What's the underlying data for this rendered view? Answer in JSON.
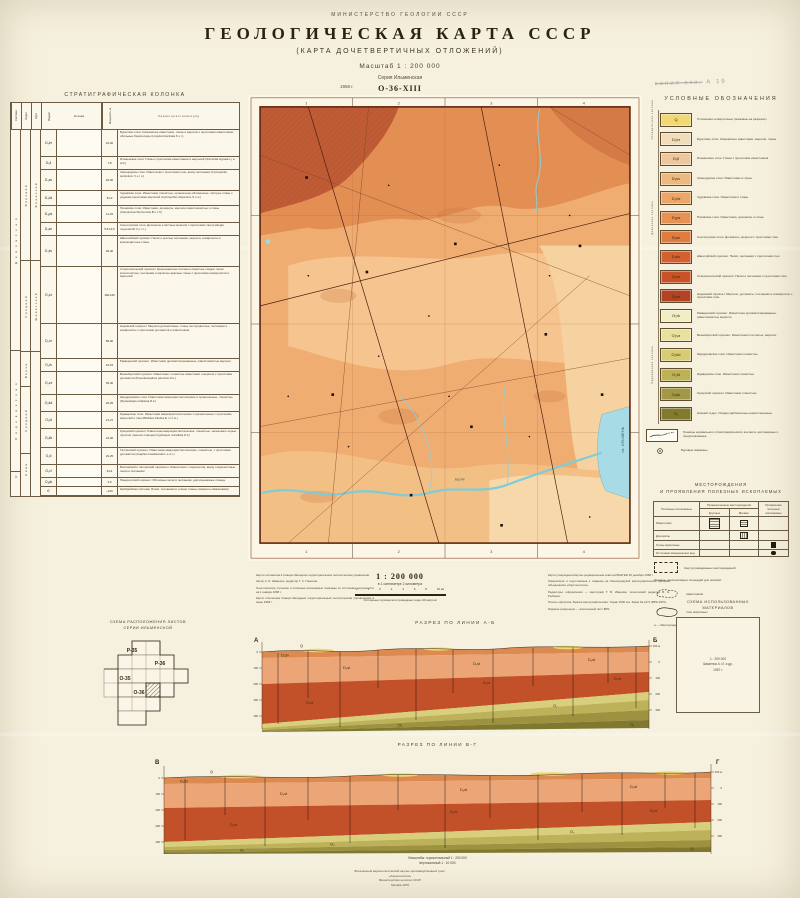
{
  "header": {
    "ministry": "МИНИСТЕРСТВО  ГЕОЛОГИИ  СССР",
    "title": "ГЕОЛОГИЧЕСКАЯ  КАРТА  СССР",
    "subtitle": "(КАРТА  ДОЧЕТВЕРТИЧНЫХ  ОТЛОЖЕНИЙ)",
    "scale": "Масштаб 1 : 200 000",
    "series": "Серия Ильменская",
    "sheet": "О-36-XIII",
    "year": "1958 г.",
    "stamp_strike": "копия экз.",
    "stamp": "А 19"
  },
  "strat": {
    "title": "СТРАТИГРАФИЧЕСКАЯ  КОЛОНКА",
    "head": {
      "system": "Система",
      "otdel": "Отдел",
      "yarus": "Ярус",
      "index": "Индекс",
      "column": "Колонка",
      "thickness": "Мощность, м",
      "desc": "Х а р а к т е р и с т и к а   п о р о д"
    },
    "systems": {
      "devon": "Д е в о н с к а я",
      "ordovik": "О р д о в и к с к а я",
      "cambr": "Є"
    },
    "otdels": {
      "o1": "Верхний",
      "o2": "Средний",
      "o3": "Верхн.",
      "o4": "Средний",
      "o5": "Нижн."
    },
    "yaruses": {
      "y1": "Франский",
      "y2": "Живетский"
    },
    "rows": [
      {
        "index": "D₃br",
        "thick": "10-30",
        "pattern": "limestone",
        "h": "26px",
        "desc": "Бурегские слои. Комковатые известняки, глины и мергели с прослоями известняков; обильные брахиоподы (Lingula bicarinata K u t.)"
      },
      {
        "index": "D₃il",
        "thick": "7-8",
        "pattern": "clay",
        "h": "12px",
        "desc": "Ильменские слои. Глины с прослоями известняков и мергелей (Svinordia signata L j a sch.)"
      },
      {
        "index": "D₃sv",
        "thick": "20-30",
        "pattern": "limestone",
        "h": "20px",
        "desc": "Свинордские слои. Известняки с прослоями глин, внизу песчаники (Cyrtospirifer tenticulum V e r n.)"
      },
      {
        "index": "D₃čd",
        "thick": "8-10",
        "pattern": "limestone",
        "h": "14px",
        "desc": "Чудовские слои. Известняки глинистые, органогенно-обломочные, пёстрые глины с редкими прослоями мергелей (Cyrtospirifer disjunctus S o w.)"
      },
      {
        "index": "D₃ps",
        "thick": "11-23",
        "pattern": "dolomite",
        "h": "16px",
        "desc": "Псковские слои. Известняки, доломиты, мергели известковистые и глины (Camarotoechia livonica B u c h)"
      },
      {
        "index": "D₃sn",
        "thick": "5,5-10,5",
        "pattern": "marl",
        "h": "12px",
        "desc": "Снетогорские слои. Доломиты и пёстрые мергели с прослоями глин (Ladogia meyendorfii V e r n.)"
      },
      {
        "index": "D₃šv",
        "thick": "30-40",
        "pattern": "sand",
        "h": "30px",
        "desc": "Швентойский горизонт. Пески и рыхлые песчаники, мергели, алевролиты и красноцветные глины"
      },
      {
        "index": "D₂st",
        "thick": "100-140",
        "pattern": "sand",
        "h": "56px",
        "desc": "Старооскольский горизонт. Красноцветные песчано-глинистые осадки: пески косослоистые, песчаники и кирпично-красные глины с прослоями алевролитов и мергелей"
      },
      {
        "index": "D₂nr",
        "thick": "80-90",
        "pattern": "marl",
        "h": "34px",
        "desc": "Наровский горизонт. Мергели доломитовые, глины пестроцветные, песчаники и алевролиты с прослоями доломитов и известняков"
      },
      {
        "index": "O₂rk",
        "thick": "10-15",
        "pattern": "dolomite",
        "h": "12px",
        "desc": "Раквереский горизонт. Известняки доломитизированные, известковистые мергели"
      },
      {
        "index": "O₂vz",
        "thick": "35-40",
        "pattern": "limestone",
        "h": "22px",
        "desc": "Везенбергский горизонт. Известняки, глинистые известняки и мергели с прослоями доломитов (Pseudoasaphus parvulus И в.)"
      },
      {
        "index": "O₂šd",
        "thick": "20-25",
        "pattern": "limestone",
        "h": "16px",
        "desc": "Шундоровские слои. Известняки микрокристаллические и органогенные, глинистые (Rystedaspis uhakiana И в.)"
      },
      {
        "index": "O₂id",
        "thick": "21-27",
        "pattern": "limestone",
        "h": "16px",
        "desc": "Идаверские слои. Известняки микрокристаллические и органогенные с прослоями мергелей и глин (Bilobites bilobus E i c h w.)"
      },
      {
        "index": "O₂kk",
        "thick": "24-30",
        "pattern": "limestone",
        "h": "18px",
        "desc": "Кукерский горизонт. Известняки микрокристаллические, глинистые, зеленовато-серые, прослои горючих сланцев (Cyphaspis mamillata И в.)"
      },
      {
        "index": "O₂tl",
        "thick": "20-25",
        "pattern": "limestone",
        "h": "16px",
        "desc": "Таллинский горизонт. Известняки микрокристаллические, глинистые, с прослоями доломитов (Asaphus kowalewskii L a w r.)"
      },
      {
        "index": "O₁vl",
        "thick": "9-14",
        "pattern": "limestone",
        "h": "12px",
        "desc": "Волховский и латорпский горизонты. Известняки с глауконитом, внизу глауконитовые пески и песчаники"
      },
      {
        "index": "O₁pk",
        "thick": "4-6",
        "pattern": "sand",
        "h": "8px",
        "desc": "Пакерортский горизонт. Оболовые пески и песчаники, диктионемовые сланцы"
      },
      {
        "index": "Є",
        "thick": "~120",
        "pattern": "clay",
        "h": "8px",
        "desc": "Кембрийская система. Пески, песчаники и «синие глины» (вскрыты скважинами)"
      }
    ]
  },
  "map": {
    "segment_numbers": [
      "1",
      "2",
      "3",
      "4"
    ],
    "lake_label": "оз. ИЛЬМЕНЬ",
    "river_label": "Мста"
  },
  "legend": {
    "title": "УСЛОВНЫЕ  ОБОЗНАЧЕНИЯ",
    "groups": {
      "quaternary": "Четвертичная система",
      "devon": "Девонская система",
      "ordovik": "Ордовикская система"
    },
    "items": [
      {
        "code": "Q",
        "color": "#f0d873",
        "desc": "Отложения четвертичные (показаны на разрезах)"
      },
      {
        "code": "D₃br",
        "color": "#f2ddba",
        "desc": "Бурегские слои. Комковатые известняки, мергели, глины"
      },
      {
        "code": "D₃il",
        "color": "#eec89c",
        "desc": "Ильменские слои. Глины с прослоями известняков"
      },
      {
        "code": "D₃sv",
        "color": "#eeb981",
        "desc": "Свинордские слои. Известняки и глины"
      },
      {
        "code": "D₃čd",
        "color": "#eca768",
        "desc": "Чудовские слои. Известняки и глины"
      },
      {
        "code": "D₃ps",
        "color": "#e79252",
        "desc": "Псковские слои. Известняки, доломиты и глины"
      },
      {
        "code": "D₃sn",
        "color": "#df7c40",
        "desc": "Снетогорские слои. Доломиты, мергели с прослоями глин"
      },
      {
        "code": "D₃šv",
        "color": "#d4622f",
        "desc": "Швентойский горизонт. Пески, песчаники с прослоями глин"
      },
      {
        "code": "D₂st",
        "color": "#c85329",
        "desc": "Старооскольский горизонт. Пески и песчаники с прослоями глин"
      },
      {
        "code": "D₂nr",
        "color": "#b24423",
        "desc": "Наровский горизонт. Мергели, доломиты, песчаники и алевролиты с прослоями глин"
      },
      {
        "code": "O₂rk",
        "color": "#f1eec4",
        "desc": "Раквереский горизонт. Известняки доломитизированные, известковистые мергели"
      },
      {
        "code": "O₂vz",
        "color": "#e9e1a0",
        "desc": "Везенбергский горизонт. Известняки плитчатые, мергели"
      },
      {
        "code": "O₂šd",
        "color": "#d6cc74",
        "desc": "Шундоровские слои. Известняки глинистые"
      },
      {
        "code": "O₂id",
        "color": "#bdb258",
        "desc": "Идаверские слои. Известняки глинистые"
      },
      {
        "code": "O₂kk",
        "color": "#a29845",
        "desc": "Кукерский горизонт. Известняки глинистые"
      },
      {
        "code": "O₁",
        "color": "#827b2f",
        "desc": "Нижний отдел. Осадки карбонатные нерасчленённые"
      }
    ],
    "boundary_desc": "Границы нормального стратиграфического контакта: достоверные и предполагаемые",
    "borehole_desc": "Буровые скважины"
  },
  "minerals": {
    "title1": "МЕСТОРОЖДЕНИЯ",
    "title2": "И ПРОЯВЛЕНИЯ ПОЛЕЗНЫХ ИСКОПАЕМЫХ",
    "col_name": "Полезные ископаемые",
    "col_group": "Промышленные месторождения",
    "col_large": "Крупные",
    "col_small": "Мелкие",
    "col_prov": "Проявления полезных ископаемых",
    "rows": [
      {
        "name": "Известняки",
        "large": "hatch-large",
        "small": "hatch-small",
        "prov": ""
      },
      {
        "name": "Доломиты",
        "large": "",
        "small": "vhatch-small",
        "prov": ""
      },
      {
        "name": "Глины кирпичные",
        "large": "",
        "small": "",
        "prov": "square-filled"
      },
      {
        "name": "Источники минеральных вод",
        "large": "",
        "small": "",
        "prov": "circle-filled"
      }
    ],
    "contour_note": "Контур разведанных месторождений",
    "bounds_head": "Границы перспективных площадей для поисков:",
    "bound1": "известняков",
    "bound2": "глин кирпичных",
    "worked_note": "а — Месторождения отработанные или законсервированные"
  },
  "scaleblock": {
    "main": "1 : 200 000",
    "sub": "в 1 сантиметре 2 километра",
    "nums": [
      "2",
      "1",
      "0",
      "2",
      "4",
      "6",
      "8",
      "10 км"
    ],
    "note": "Сплошные горизонтали проведены через 40 метров"
  },
  "credits_left": {
    "p1": "Карта составлена в Северо-Западном территориальном геологическом управлении.",
    "p2": "Автор А. И. Шмаенок, редактор Г. С. Ганешин.",
    "p3": "Геологическое строение и полезные ископаемые показаны по состоянию изученности на 1 января 1968 г.",
    "p4": "Карта отпечатана Северо-Западным территориальным геологическим управлением в июне 1968 г."
  },
  "credits_right": {
    "p1": "Карта утверждена Научно-редакционным советом ВСЕГЕИ 26 декабря 1968 г.",
    "p2": "Оформлена и подготовлена к изданию на Ленинградской картографической фабрике объединения «Аэрогеология».",
    "p3": "Редакторы: оформления — картограф Т. В. Иванова; технический редактор В. Н. Рыбкина.",
    "p4": "Печать офсетная. Бумага картографическая. Тираж 1500 экз. Заказ № 1271 (ВРК-1970).",
    "p5": "Издание разрешено — всесоюзный лист ВРК."
  },
  "sheets_scheme": {
    "title1": "СХЕМА РАСПОЛОЖЕНИЯ ЛИСТОВ",
    "title2": "СЕРИИ ИЛЬМЕНСКОЙ",
    "labels": [
      "Р-35",
      "Р-36",
      "О-35",
      "О-36"
    ]
  },
  "materials_scheme": {
    "title1": "СХЕМА ИСПОЛЬЗОВАННЫХ",
    "title2": "МАТЕРИАЛОВ",
    "box_line1": "1 : 200 000",
    "box_line2": "Шмаенок А. И. и др.",
    "box_line3": "1967 г."
  },
  "sections": {
    "ab_title": "РАЗРЕЗ  ПО  ЛИНИИ  А-Б",
    "vg_title": "РАЗРЕЗ  ПО  ЛИНИИ  В-Г",
    "ab_left": "А",
    "ab_right": "Б",
    "vg_left": "В",
    "vg_right": "Г",
    "units": {
      "q": "Q",
      "shv": "D₃šv",
      "st": "D₂st",
      "nr": "D₂nr",
      "o2": "O₂",
      "o1": "O₁"
    },
    "elev": [
      "100 м",
      "0",
      "100",
      "200",
      "300",
      "400"
    ],
    "scales_line1": "Масштабы:  горизонтальный 1 : 200 000",
    "scales_line2": "вертикальный 1 : 10 000"
  },
  "imprint": {
    "l1": "Всесоюзный аэрогеологический научно-производственный трест",
    "l2": "«Аэрогеология»",
    "l3": "Министерства геологии СССР",
    "l4": "Москва 1970"
  }
}
